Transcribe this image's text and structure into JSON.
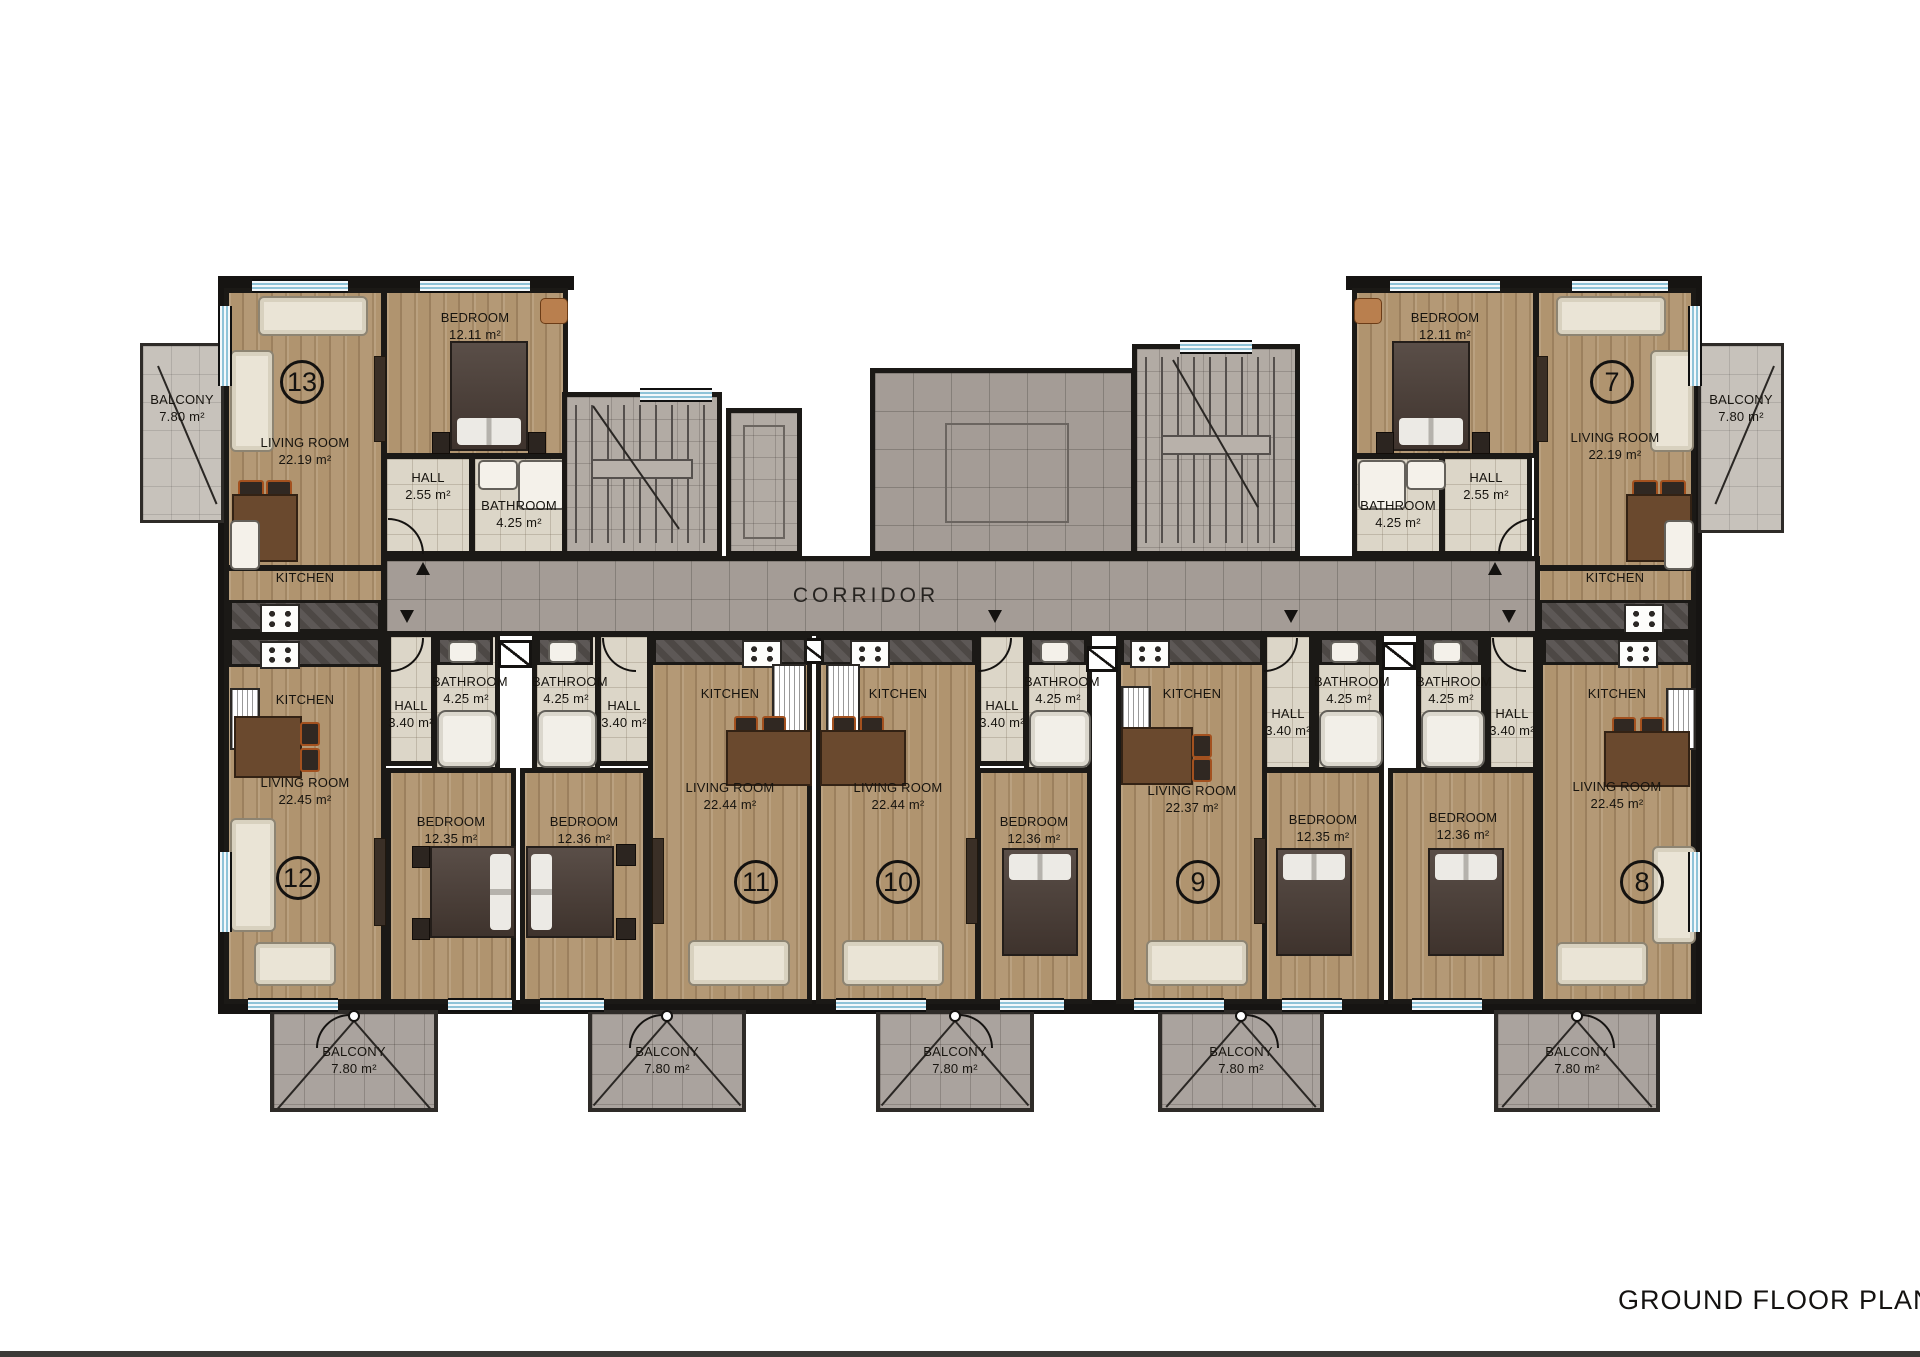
{
  "title": "GROUND FLOOR PLAN",
  "corridor_label": "CORRIDOR",
  "room_names": {
    "living": "LIVING ROOM",
    "bedroom": "BEDROOM",
    "kitchen": "KITCHEN",
    "hall": "HALL",
    "bathroom": "BATHROOM",
    "balcony": "BALCONY"
  },
  "units": [
    {
      "number": "13",
      "living_area": "22.19 m²",
      "bedroom_area": "12.11 m²",
      "hall_area": "2.55 m²",
      "bathroom_area": "4.25 m²",
      "balcony_area": "7.80 m²"
    },
    {
      "number": "7",
      "living_area": "22.19 m²",
      "bedroom_area": "12.11 m²",
      "hall_area": "2.55 m²",
      "bathroom_area": "4.25 m²",
      "balcony_area": "7.80 m²"
    },
    {
      "number": "12",
      "living_area": "22.45 m²",
      "bedroom_area": "12.35 m²",
      "hall_area": "3.40 m²",
      "bathroom_area": "4.25 m²",
      "balcony_area": "7.80 m²"
    },
    {
      "number": "11",
      "living_area": "22.44 m²",
      "bedroom_area": "12.36 m²",
      "hall_area": "3.40 m²",
      "bathroom_area": "4.25 m²",
      "balcony_area": "7.80 m²"
    },
    {
      "number": "10",
      "living_area": "22.44 m²",
      "bedroom_area": "12.36 m²",
      "hall_area": "3.40 m²",
      "bathroom_area": "4.25 m²",
      "balcony_area": "7.80 m²"
    },
    {
      "number": "9",
      "living_area": "22.37 m²",
      "bedroom_area": "12.35 m²",
      "hall_area": "3.40 m²",
      "bathroom_area": "4.25 m²",
      "balcony_area": "7.80 m²"
    },
    {
      "number": "8",
      "living_area": "22.45 m²",
      "bedroom_area": "12.36 m²",
      "hall_area": "3.40 m²",
      "bathroom_area": "4.25 m²",
      "balcony_area": "7.80 m²"
    }
  ]
}
